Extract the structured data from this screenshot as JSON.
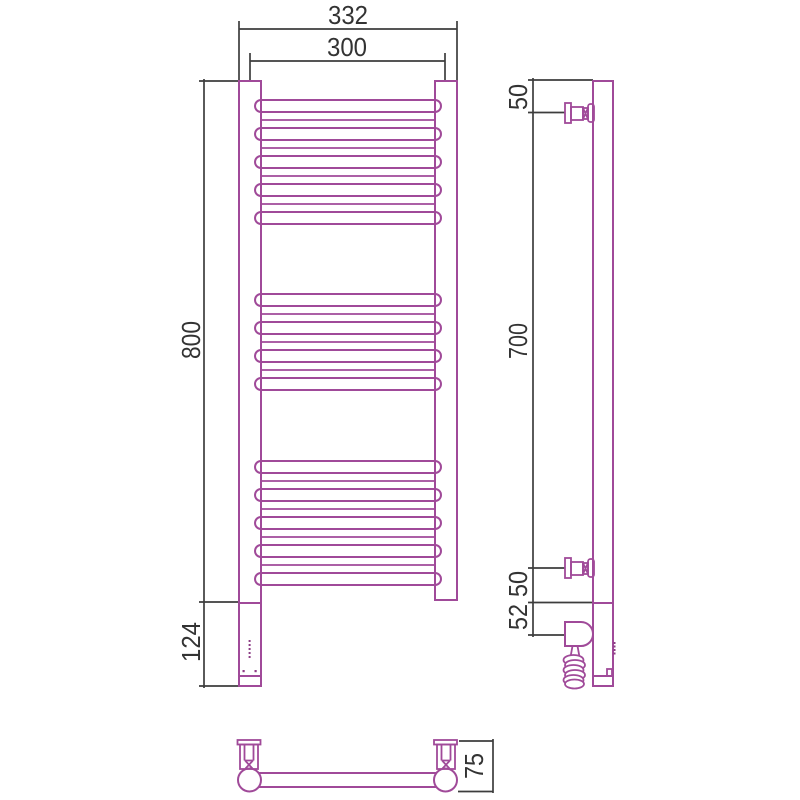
{
  "drawing_labels": {
    "front_view": {
      "overall_width_mm": "332",
      "rail_center_spacing_mm": "300",
      "overall_height_mm": "800",
      "heater_section_height_mm": "124"
    },
    "side_view": {
      "top_bracket_offset_mm": "50",
      "bracket_spacing_mm": "700",
      "bottom_bracket_offset_mm": "50",
      "heater_extension_mm": "52"
    },
    "bottom_view": {
      "wall_depth_mm": "75"
    }
  },
  "colors": {
    "product_line": "#a04a99",
    "dimension_line": "#3d3d3d",
    "background": "#ffffff"
  }
}
